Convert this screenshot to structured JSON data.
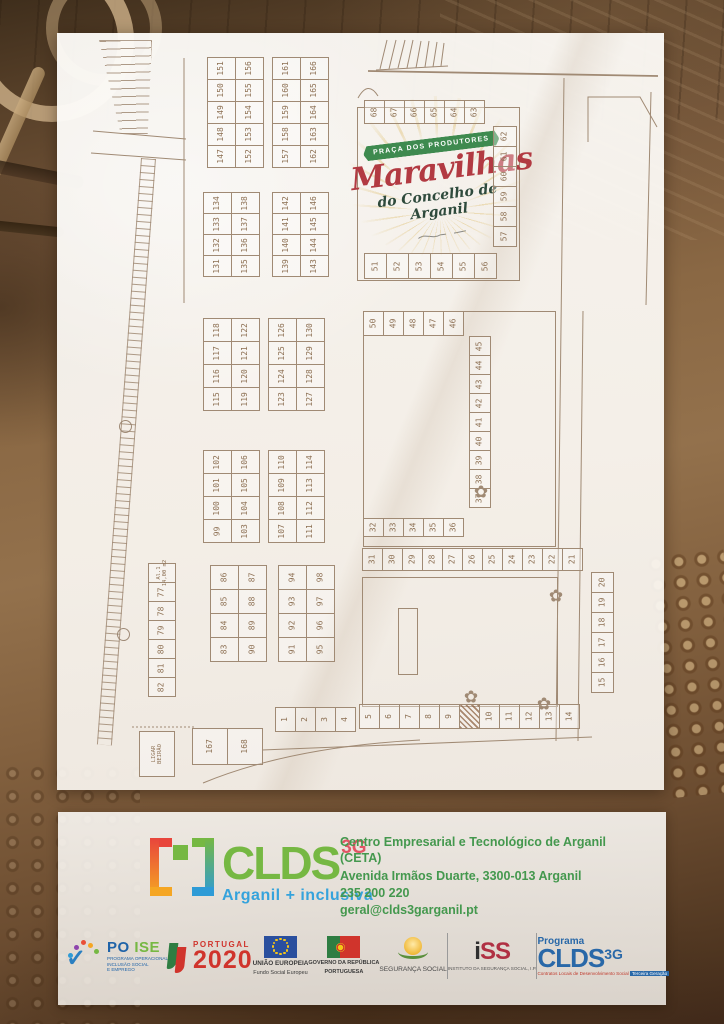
{
  "plan": {
    "logo": {
      "banner": "PRAÇA DOS PRODUTORES",
      "title": "Maravilhas",
      "subtitle": "do Concelho de Arganil"
    },
    "groups": [
      {
        "id": "g147-156",
        "x": 207,
        "y": 57,
        "cw": 29,
        "ch": 23,
        "cols": [
          [
            151,
            150,
            149,
            148,
            147
          ],
          [
            156,
            155,
            154,
            153,
            152
          ]
        ]
      },
      {
        "id": "g157-166",
        "x": 272,
        "y": 57,
        "cw": 29,
        "ch": 23,
        "cols": [
          [
            161,
            160,
            159,
            158,
            157
          ],
          [
            166,
            165,
            164,
            163,
            162
          ]
        ]
      },
      {
        "id": "g131-138",
        "x": 203,
        "y": 192,
        "cw": 29,
        "ch": 22,
        "cols": [
          [
            134,
            133,
            132,
            131
          ],
          [
            138,
            137,
            136,
            135
          ]
        ]
      },
      {
        "id": "g139-146",
        "x": 272,
        "y": 192,
        "cw": 29,
        "ch": 22,
        "cols": [
          [
            142,
            141,
            140,
            139
          ],
          [
            146,
            145,
            144,
            143
          ]
        ]
      },
      {
        "id": "g115-122",
        "x": 203,
        "y": 318,
        "cw": 29,
        "ch": 24,
        "cols": [
          [
            118,
            117,
            116,
            115
          ],
          [
            122,
            121,
            120,
            119
          ]
        ]
      },
      {
        "id": "g123-130",
        "x": 268,
        "y": 318,
        "cw": 29,
        "ch": 24,
        "cols": [
          [
            126,
            125,
            124,
            123
          ],
          [
            130,
            129,
            128,
            127
          ]
        ]
      },
      {
        "id": "g99-106",
        "x": 203,
        "y": 450,
        "cw": 29,
        "ch": 24,
        "cols": [
          [
            102,
            101,
            100,
            99
          ],
          [
            106,
            105,
            104,
            103
          ]
        ]
      },
      {
        "id": "g107-114",
        "x": 268,
        "y": 450,
        "cw": 29,
        "ch": 24,
        "cols": [
          [
            110,
            109,
            108,
            107
          ],
          [
            114,
            113,
            112,
            111
          ]
        ]
      },
      {
        "id": "g83-90",
        "x": 210,
        "y": 565,
        "cw": 29,
        "ch": 25,
        "cols": [
          [
            86,
            85,
            84,
            83
          ],
          [
            87,
            88,
            89,
            90
          ]
        ]
      },
      {
        "id": "g91-98",
        "x": 278,
        "y": 565,
        "cw": 29,
        "ch": 25,
        "cols": [
          [
            94,
            93,
            92,
            91
          ],
          [
            98,
            97,
            96,
            95
          ]
        ]
      },
      {
        "id": "g77-82",
        "x": 148,
        "y": 563,
        "cw": 28,
        "ch": 20,
        "cols": [
          [
            "Al.1|14,00 m2",
            77,
            78,
            79,
            80,
            81,
            82
          ]
        ]
      },
      {
        "id": "g167-168",
        "x": 192,
        "y": 728,
        "cw": 36,
        "ch": 37,
        "row": [
          167,
          168
        ]
      },
      {
        "id": "g63-68",
        "x": 364,
        "y": 100,
        "cw": 21,
        "ch": 24,
        "row": [
          68,
          67,
          66,
          65,
          64,
          63
        ]
      },
      {
        "id": "g57-62",
        "x": 493,
        "y": 126,
        "cw": 24,
        "ch": 21,
        "cols": [
          [
            62,
            61,
            60,
            59,
            58,
            57
          ]
        ]
      },
      {
        "id": "g51-56",
        "x": 364,
        "y": 253,
        "cw": 23,
        "ch": 26,
        "row": [
          51,
          52,
          53,
          54,
          55,
          56
        ]
      },
      {
        "id": "g46-50",
        "x": 363,
        "y": 311,
        "cw": 21,
        "ch": 25,
        "row": [
          50,
          49,
          48,
          47,
          46
        ]
      },
      {
        "id": "g37-45",
        "x": 469,
        "y": 336,
        "cw": 22,
        "ch": 20,
        "cols": [
          [
            45,
            44,
            43,
            42,
            41,
            40,
            39,
            38,
            37
          ]
        ]
      },
      {
        "id": "g32-36",
        "x": 363,
        "y": 518,
        "cw": 21,
        "ch": 19,
        "row": [
          32,
          33,
          34,
          35,
          36
        ]
      },
      {
        "id": "g21-31",
        "x": 362,
        "y": 548,
        "cw": 21,
        "ch": 23,
        "row": [
          31,
          30,
          29,
          28,
          27,
          26,
          25,
          24,
          23,
          22,
          21
        ]
      },
      {
        "id": "g15-20",
        "x": 591,
        "y": 572,
        "cw": 23,
        "ch": 21,
        "cols": [
          [
            20,
            19,
            18,
            17,
            16,
            15
          ]
        ]
      },
      {
        "id": "g1-4",
        "x": 275,
        "y": 707,
        "cw": 21,
        "ch": 25,
        "row": [
          1,
          2,
          3,
          4
        ]
      },
      {
        "id": "g5-14",
        "x": 359,
        "y": 704,
        "cw": 21,
        "ch": 25,
        "row": [
          5,
          6,
          7,
          8,
          9,
          "#hatch",
          10,
          11,
          12,
          13,
          14
        ]
      },
      {
        "id": "ligar-beirao",
        "x": 139,
        "y": 731,
        "cw": 36,
        "ch": 46,
        "row": [
          "LIGAR|BEIRÃO"
        ]
      }
    ],
    "trees": [
      {
        "x": 481,
        "y": 492
      },
      {
        "x": 556,
        "y": 596
      },
      {
        "x": 471,
        "y": 697
      },
      {
        "x": 544,
        "y": 704
      }
    ]
  },
  "footer": {
    "clds": {
      "name": "CLDS",
      "sup": "3G",
      "tagline": "Arganil + inclusiva"
    },
    "contact": {
      "line1": "Centro Empresarial e Tecnológico de Arganil (CETA)",
      "line2": "Avenida Irmãos Duarte, 3300-013 Arganil",
      "line3": "235 200 220",
      "line4": "geral@clds3garganil.pt"
    },
    "logos": {
      "poise": {
        "name_blue": "PO",
        "name_green": "ISE",
        "sub": "PROGRAMA OPERACIONAL\nINCLUSÃO SOCIAL\nE EMPREGO"
      },
      "pt2020": {
        "top": "PORTUGAL",
        "big": "2020"
      },
      "ue": {
        "line1": "UNIÃO EUROPEIA",
        "line2": "Fundo Social Europeu"
      },
      "gov": {
        "line1": "GOVERNO DA REPÚBLICA",
        "line2": "PORTUGUESA"
      },
      "seg": {
        "name": "SEGURANÇA SOCIAL"
      },
      "iss": {
        "i": "i",
        "ss": "SS",
        "sub": "INSTITUTO DA SEGURANÇA SOCIAL, I.P."
      },
      "programa": {
        "top": "Programa",
        "name": "CLDS",
        "sup": "3G",
        "caption_red": "Contratos Locais de Desenvolvimento Social",
        "caption_blue": "Terceira Geração"
      }
    }
  },
  "colors": {
    "clds_green": "#76b843",
    "clds_blue": "#35a3dc",
    "clds_red": "#e25565",
    "banner_green": "#3e8a4f",
    "title_red": "#b23a42",
    "contact_green": "#44984e",
    "plan_line": "#a08a74",
    "pt_red": "#d0342c",
    "eu_blue": "#2a4f9e",
    "programa_blue": "#2968a8"
  }
}
